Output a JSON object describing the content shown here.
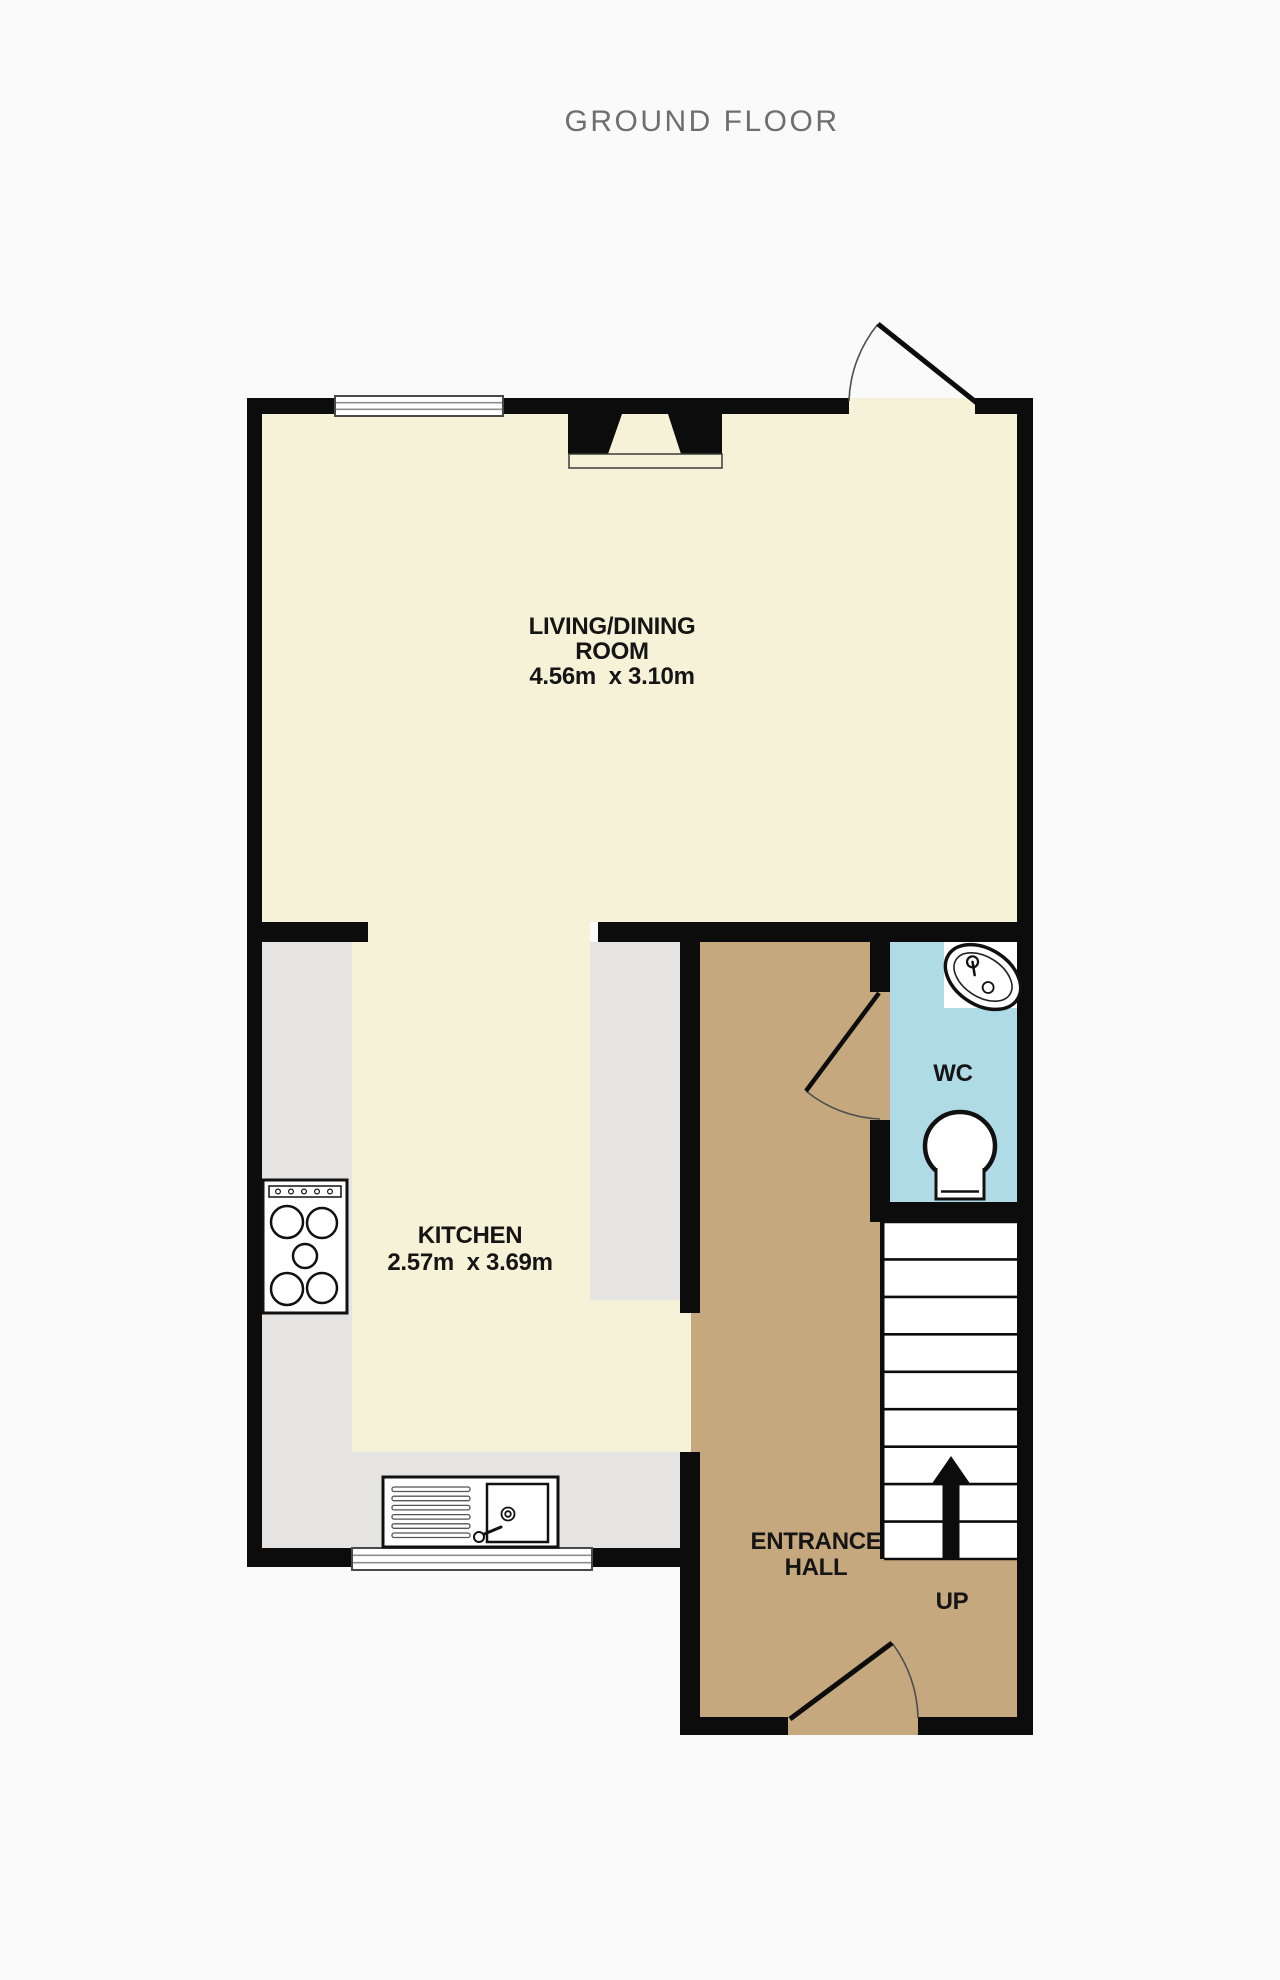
{
  "title": "GROUND FLOOR",
  "floor_plan": {
    "rooms": {
      "living": {
        "name_line1": "LIVING/DINING",
        "name_line2": "ROOM",
        "dimensions": "4.56m  x 3.10m"
      },
      "kitchen": {
        "name": "KITCHEN",
        "dimensions": "2.57m  x 3.69m"
      },
      "wc": {
        "name": "WC"
      },
      "hall": {
        "name_line1": "ENTRANCE",
        "name_line2": "HALL"
      }
    },
    "stairs": {
      "direction_label": "UP",
      "tread_count": 9
    }
  },
  "colors": {
    "wall": "#0c0c0c",
    "living_floor": "#f6f2d7",
    "kitchen_counter": "#e5e4e2",
    "hall_floor": "#c6a87e",
    "wc_floor": "#aedbe6",
    "background": "#fbfafa",
    "title_text": "#6e6e6e",
    "label_text": "#151515"
  }
}
